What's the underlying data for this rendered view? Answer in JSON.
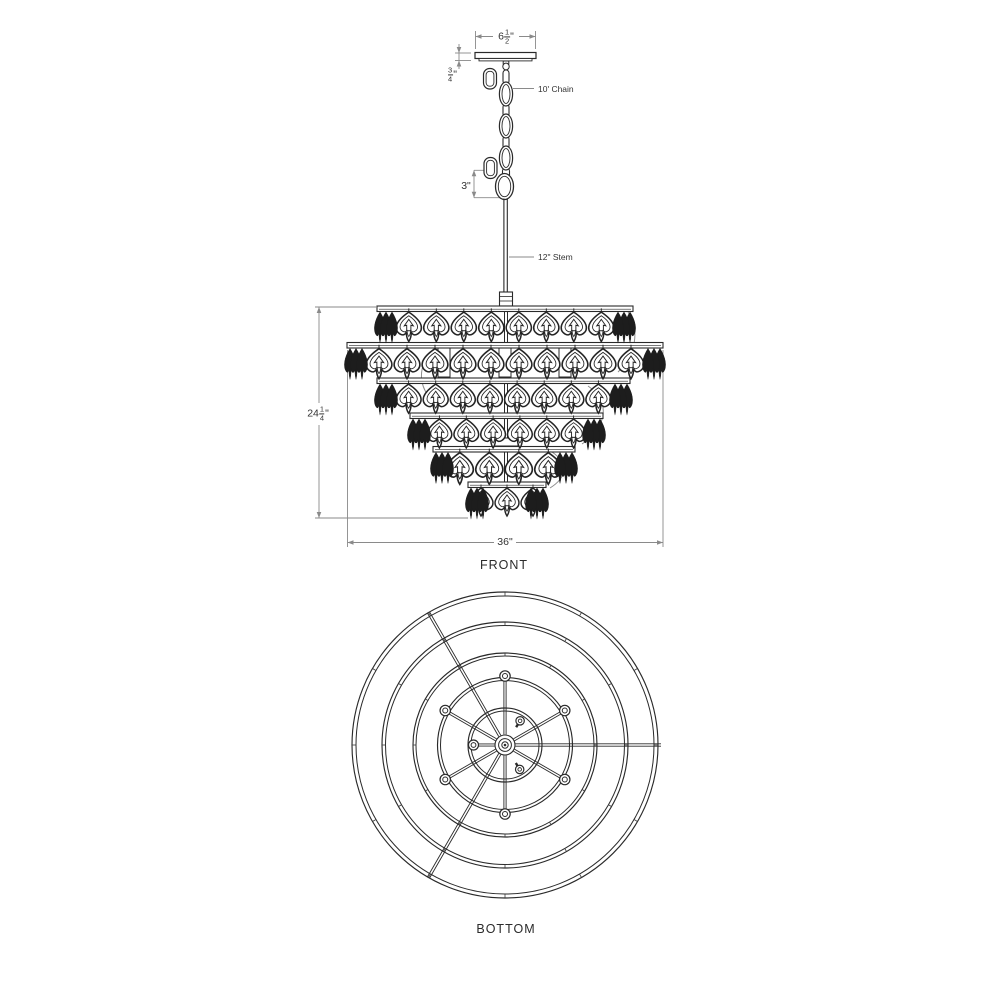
{
  "drawing": {
    "front": {
      "name": "FRONT",
      "canopy_width_whole": "6",
      "canopy_width_num": "1",
      "canopy_width_den": "2",
      "canopy_width_unit": "\"",
      "canopy_height_num": "3",
      "canopy_height_den": "4",
      "canopy_height_unit": "\"",
      "chain_label": "10' Chain",
      "loop_height": "3\"",
      "stem_label": "12\" Stem",
      "body_height_whole": "24",
      "body_height_num": "1",
      "body_height_den": "4",
      "body_height_unit": "\"",
      "body_width": "36\""
    },
    "bottom": {
      "name": "BOTTOM"
    }
  },
  "geometry": {
    "front": {
      "tiers": [
        {
          "plate": [
            377,
            633
          ],
          "y": 306,
          "drops": 8,
          "inset": 18
        },
        {
          "plate": [
            347,
            663
          ],
          "y": 342.5,
          "drops": 10,
          "inset": 18
        },
        {
          "plate": [
            377,
            630
          ],
          "y": 378,
          "drops": 8,
          "inset": 18
        },
        {
          "plate": [
            410,
            603
          ],
          "y": 413,
          "drops": 6,
          "inset": 16
        },
        {
          "plate": [
            433,
            575
          ],
          "y": 446.5,
          "drops": 4,
          "inset": 12
        },
        {
          "plate": [
            468,
            546
          ],
          "y": 482,
          "drops": 3,
          "inset": 0
        }
      ],
      "chain_link_centers": [
        94,
        126,
        158
      ],
      "stem": {
        "top": 198.5,
        "bottom": 292
      }
    },
    "bottom": {
      "center": [
        505,
        745
      ],
      "rings": [
        [
          153,
          149
        ],
        [
          123,
          119.5
        ],
        [
          92,
          89
        ],
        [
          67.5,
          64.5
        ],
        [
          37,
          34
        ]
      ],
      "bolt_angles": [
        30,
        90,
        150,
        210,
        270,
        330
      ],
      "arm_angles": [
        0,
        120,
        240
      ],
      "tick_step_deg": 30
    }
  },
  "colors": {
    "line": "#2a2a2a",
    "dim": "#8a8a8a",
    "text": "#333333",
    "bg": "#ffffff"
  }
}
